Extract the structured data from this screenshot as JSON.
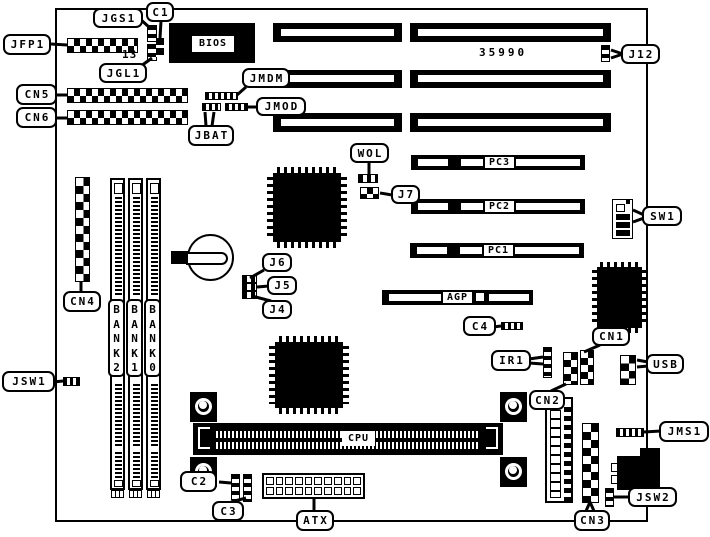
{
  "board": {
    "part_number": "35990",
    "pin_label": "13"
  },
  "chips": {
    "bios_label": "BIOS"
  },
  "slots": {
    "pci": [
      "PC3",
      "PC2",
      "PC1"
    ],
    "agp_label": "AGP",
    "cpu_label": "CPU"
  },
  "memory": {
    "banks": [
      "BANK2",
      "BANK1",
      "BANK0"
    ]
  },
  "callouts": {
    "jfp1": "JFP1",
    "jgs1": "JGS1",
    "c1": "C1",
    "jgl1": "JGL1",
    "jmdm": "JMDM",
    "jmod": "JMOD",
    "cn5": "CN5",
    "cn6": "CN6",
    "jbat": "JBAT",
    "j12": "J12",
    "wol": "WOL",
    "j7": "J7",
    "sw1": "SW1",
    "cn4": "CN4",
    "j6": "J6",
    "j5": "J5",
    "j4": "J4",
    "c4": "C4",
    "cn1": "CN1",
    "ir1": "IR1",
    "usb": "USB",
    "jsw1": "JSW1",
    "cn2": "CN2",
    "jms1": "JMS1",
    "c2": "C2",
    "c3": "C3",
    "atx": "ATX",
    "jsw2": "JSW2",
    "cn3": "CN3"
  },
  "colors": {
    "ink": "#000000",
    "paper": "#ffffff"
  }
}
